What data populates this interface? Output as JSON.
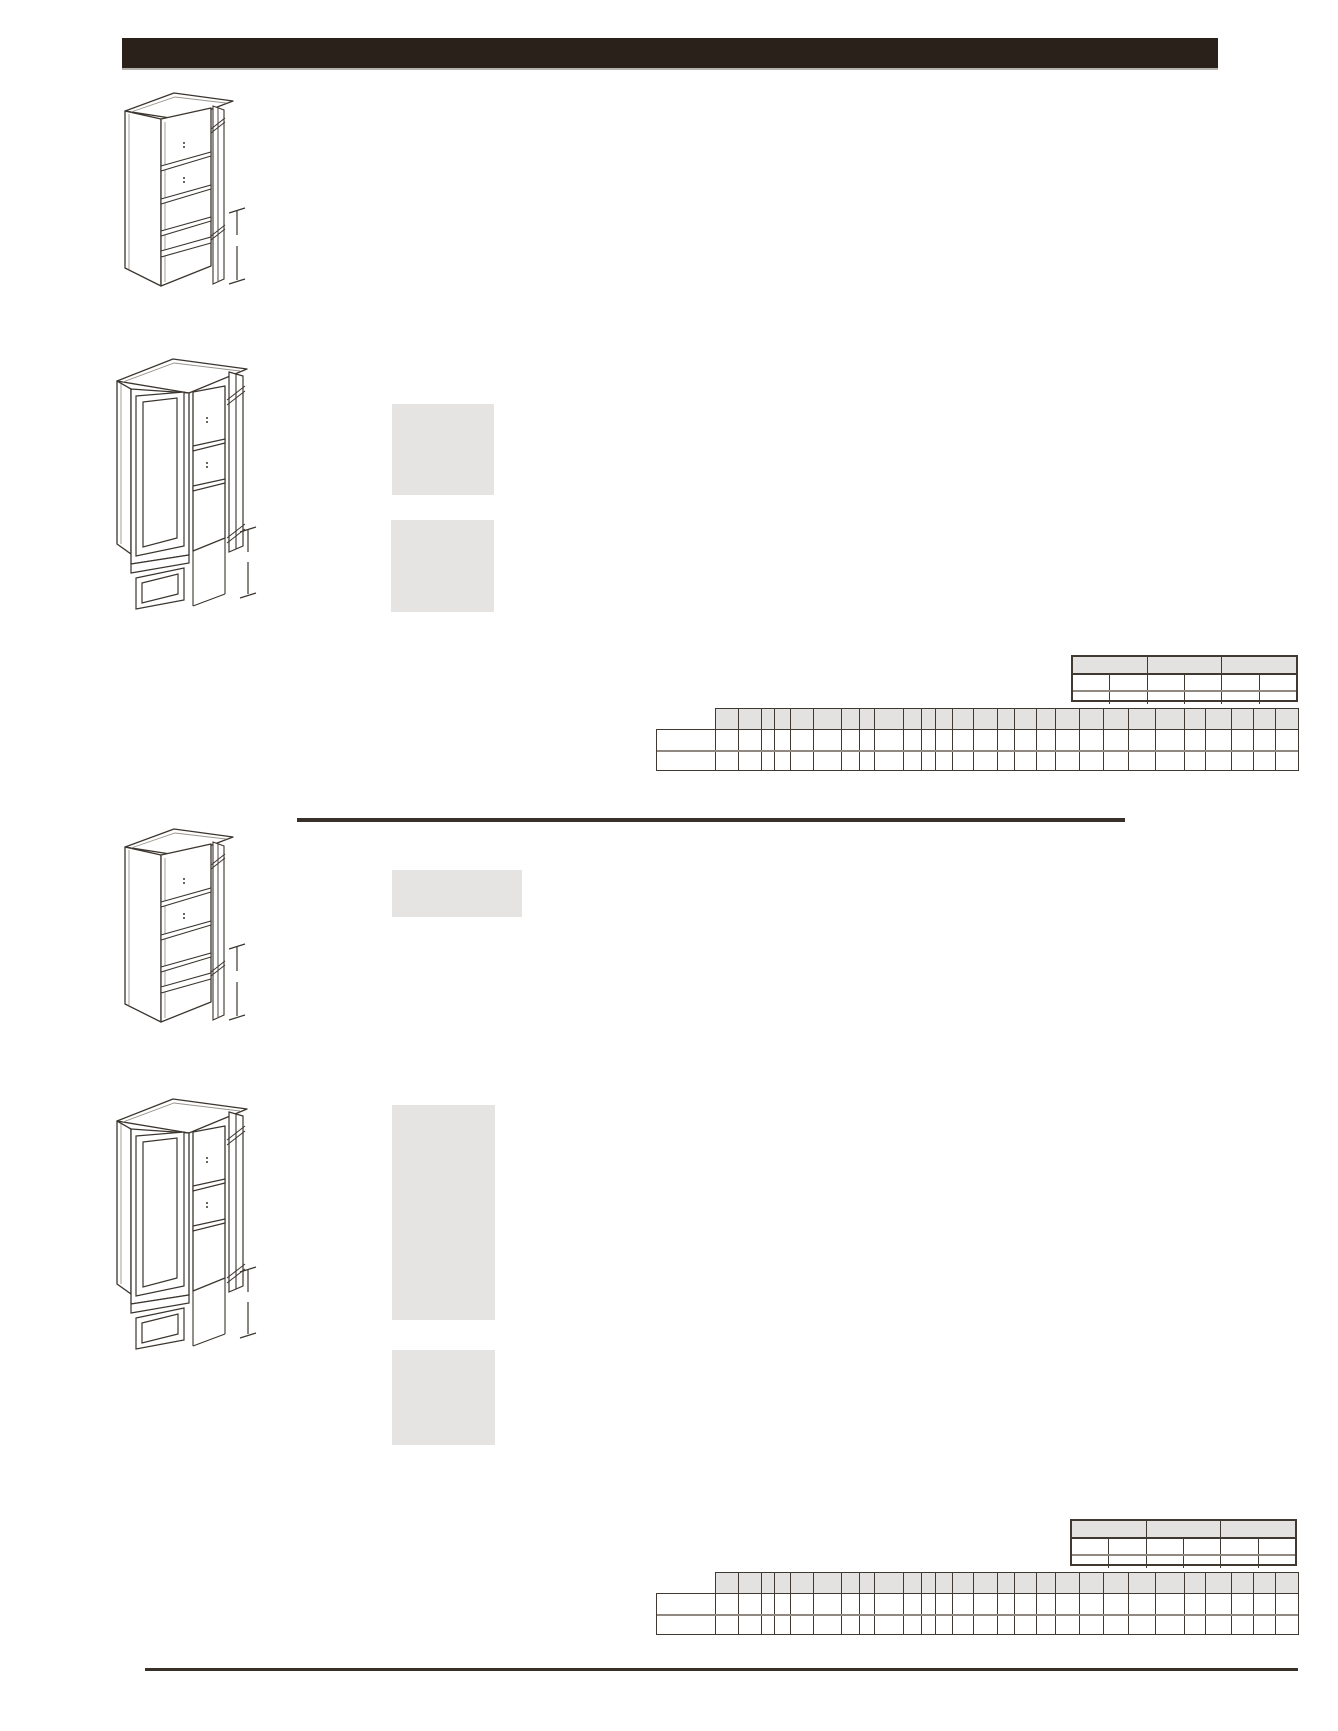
{
  "document": {
    "kind": "cabinet-specification-catalog-page",
    "visible_text": []
  },
  "colors": {
    "paper": "#ffffff",
    "header_bar": "#2a211a",
    "line_dark": "#3b352e",
    "line_shade": "#99938c",
    "placeholder_gray": "#e5e4e3",
    "table_border": "#3f3931",
    "table_border_light": "#8f8981",
    "table_header_fill": "#e3e2e1",
    "rule_dark": "#38312a"
  },
  "header_bar": {
    "title": ""
  },
  "drawings": [
    {
      "name": "tall-pantry-cabinet-open-shelves-single-door",
      "dimension_marker": true
    },
    {
      "name": "tall-pantry-cabinet-framed-glass-doors",
      "dimension_marker": true
    },
    {
      "name": "tall-pantry-cabinet-open-shelves-single-door",
      "dimension_marker": true
    },
    {
      "name": "tall-pantry-cabinet-framed-glass-doors",
      "dimension_marker": true
    }
  ],
  "placeholders": [
    {
      "name": "image-placeholder-1"
    },
    {
      "name": "image-placeholder-2"
    },
    {
      "name": "image-placeholder-3"
    },
    {
      "name": "image-placeholder-4"
    },
    {
      "name": "image-placeholder-5"
    }
  ],
  "tables": {
    "small_spec_table": {
      "instances": 2,
      "header_groups": 3,
      "columns": 6,
      "body_rows": 2,
      "row_heights": [
        18,
        15,
        14
      ],
      "cells_empty": true
    },
    "wide_spec_table": {
      "instances": 2,
      "columns": 27,
      "body_rows": 2,
      "left_stub": true,
      "stub_width": 59,
      "row_heights": [
        21,
        20,
        20
      ],
      "column_widths": [
        23,
        23,
        13,
        16,
        23,
        28,
        18,
        15,
        29,
        18,
        14,
        17,
        21,
        24,
        17,
        22,
        19,
        24,
        24,
        25,
        27,
        29,
        21,
        26,
        22,
        22,
        22
      ],
      "cells_empty": true
    }
  },
  "rules": {
    "section_divider": true,
    "footer_rule": true
  }
}
